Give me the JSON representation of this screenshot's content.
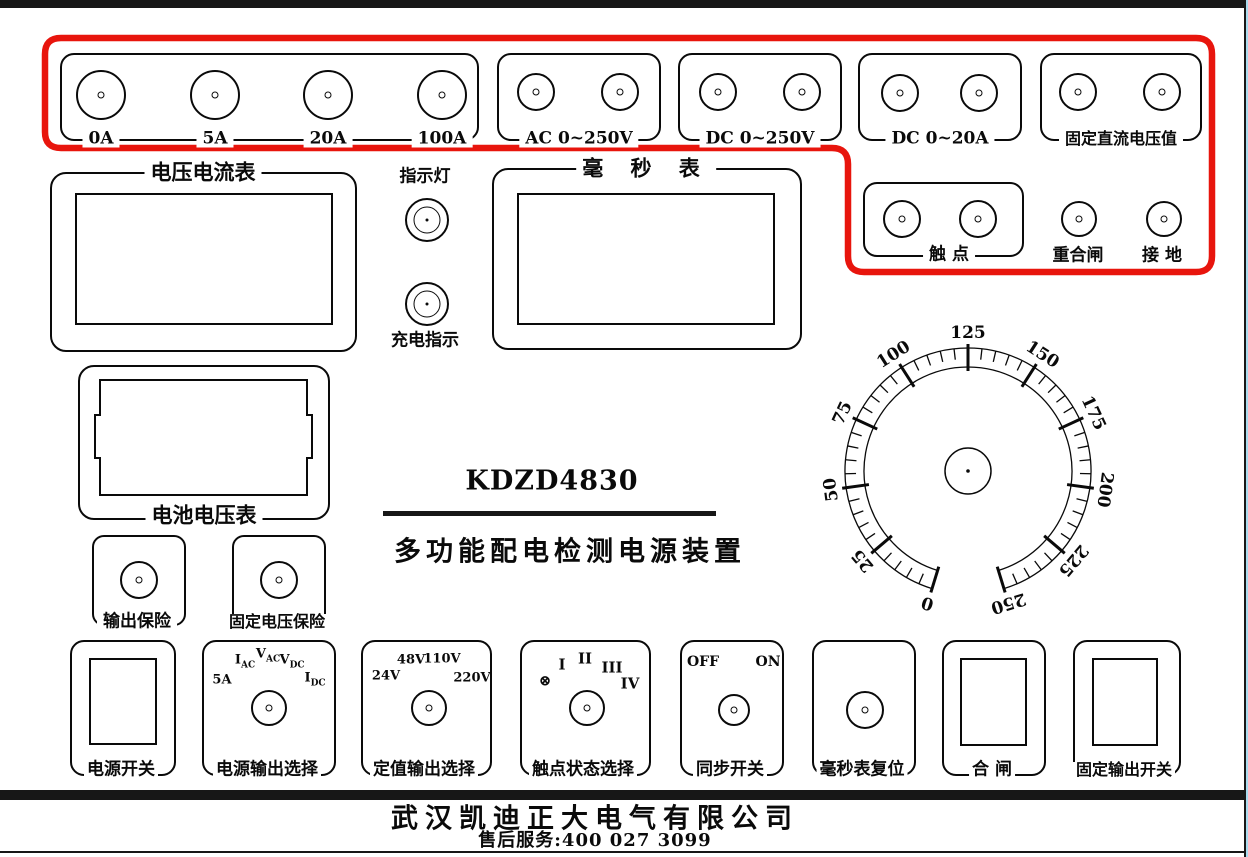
{
  "colors": {
    "highlight": "#e8150d",
    "line": "#0a0a0a"
  },
  "title": {
    "model": "KDZD4830",
    "name": "多功能配电检测电源装置"
  },
  "top_groups": {
    "current": {
      "terminal_labels": [
        "0A",
        "5A",
        "20A",
        "100A"
      ]
    },
    "ac_v": {
      "label": "AC 0~250V"
    },
    "dc_v": {
      "label": "DC 0~250V"
    },
    "dc_a": {
      "label": "DC 0~20A"
    },
    "fixed_dc": {
      "label": "固定直流电压值"
    }
  },
  "aux_terminals": {
    "contact": {
      "label": "触  点"
    },
    "reclose": {
      "label": "重合闸"
    },
    "ground": {
      "label": "接 地"
    }
  },
  "meters": {
    "volt_amp": "电压电流表",
    "millisecond": "毫 秒 表",
    "battery": "电池电压表"
  },
  "lamps": {
    "indicator": "指示灯",
    "charging": "充电指示"
  },
  "fuses": {
    "output": "输出保险",
    "fixed": "固定电压保险"
  },
  "dial": {
    "type": "dial-scale",
    "min": 0,
    "max": 250,
    "major_step": 25,
    "tick_labels": [
      "0",
      "25",
      "50",
      "75",
      "100",
      "125",
      "150",
      "175",
      "200",
      "225",
      "250"
    ],
    "start_angle_deg": -163,
    "end_angle_deg": 163,
    "minor_ticks_per_major": 5
  },
  "controls": {
    "power": "电源开关",
    "source_select": {
      "label": "电源输出选择",
      "positions": [
        {
          "main": "5A",
          "sub": ""
        },
        {
          "main": "I",
          "sub": "AC"
        },
        {
          "main": "V",
          "sub": "AC"
        },
        {
          "main": "V",
          "sub": "DC"
        },
        {
          "main": "I",
          "sub": "DC"
        }
      ]
    },
    "fixed_select": {
      "label": "定值输出选择",
      "positions": [
        "24V",
        "48V",
        "110V",
        "220V"
      ]
    },
    "contact_select": {
      "label": "触点状态选择",
      "positions": [
        "⊗",
        "I",
        "II",
        "III",
        "IV"
      ]
    },
    "sync": {
      "label": "同步开关",
      "off": "OFF",
      "on": "ON"
    },
    "reset": "毫秒表复位",
    "close": "合  闸",
    "fixed_switch": "固定输出开关"
  },
  "footer": {
    "company": "武汉凯迪正大电气有限公司",
    "service": "售后服务:400 027 3099"
  }
}
